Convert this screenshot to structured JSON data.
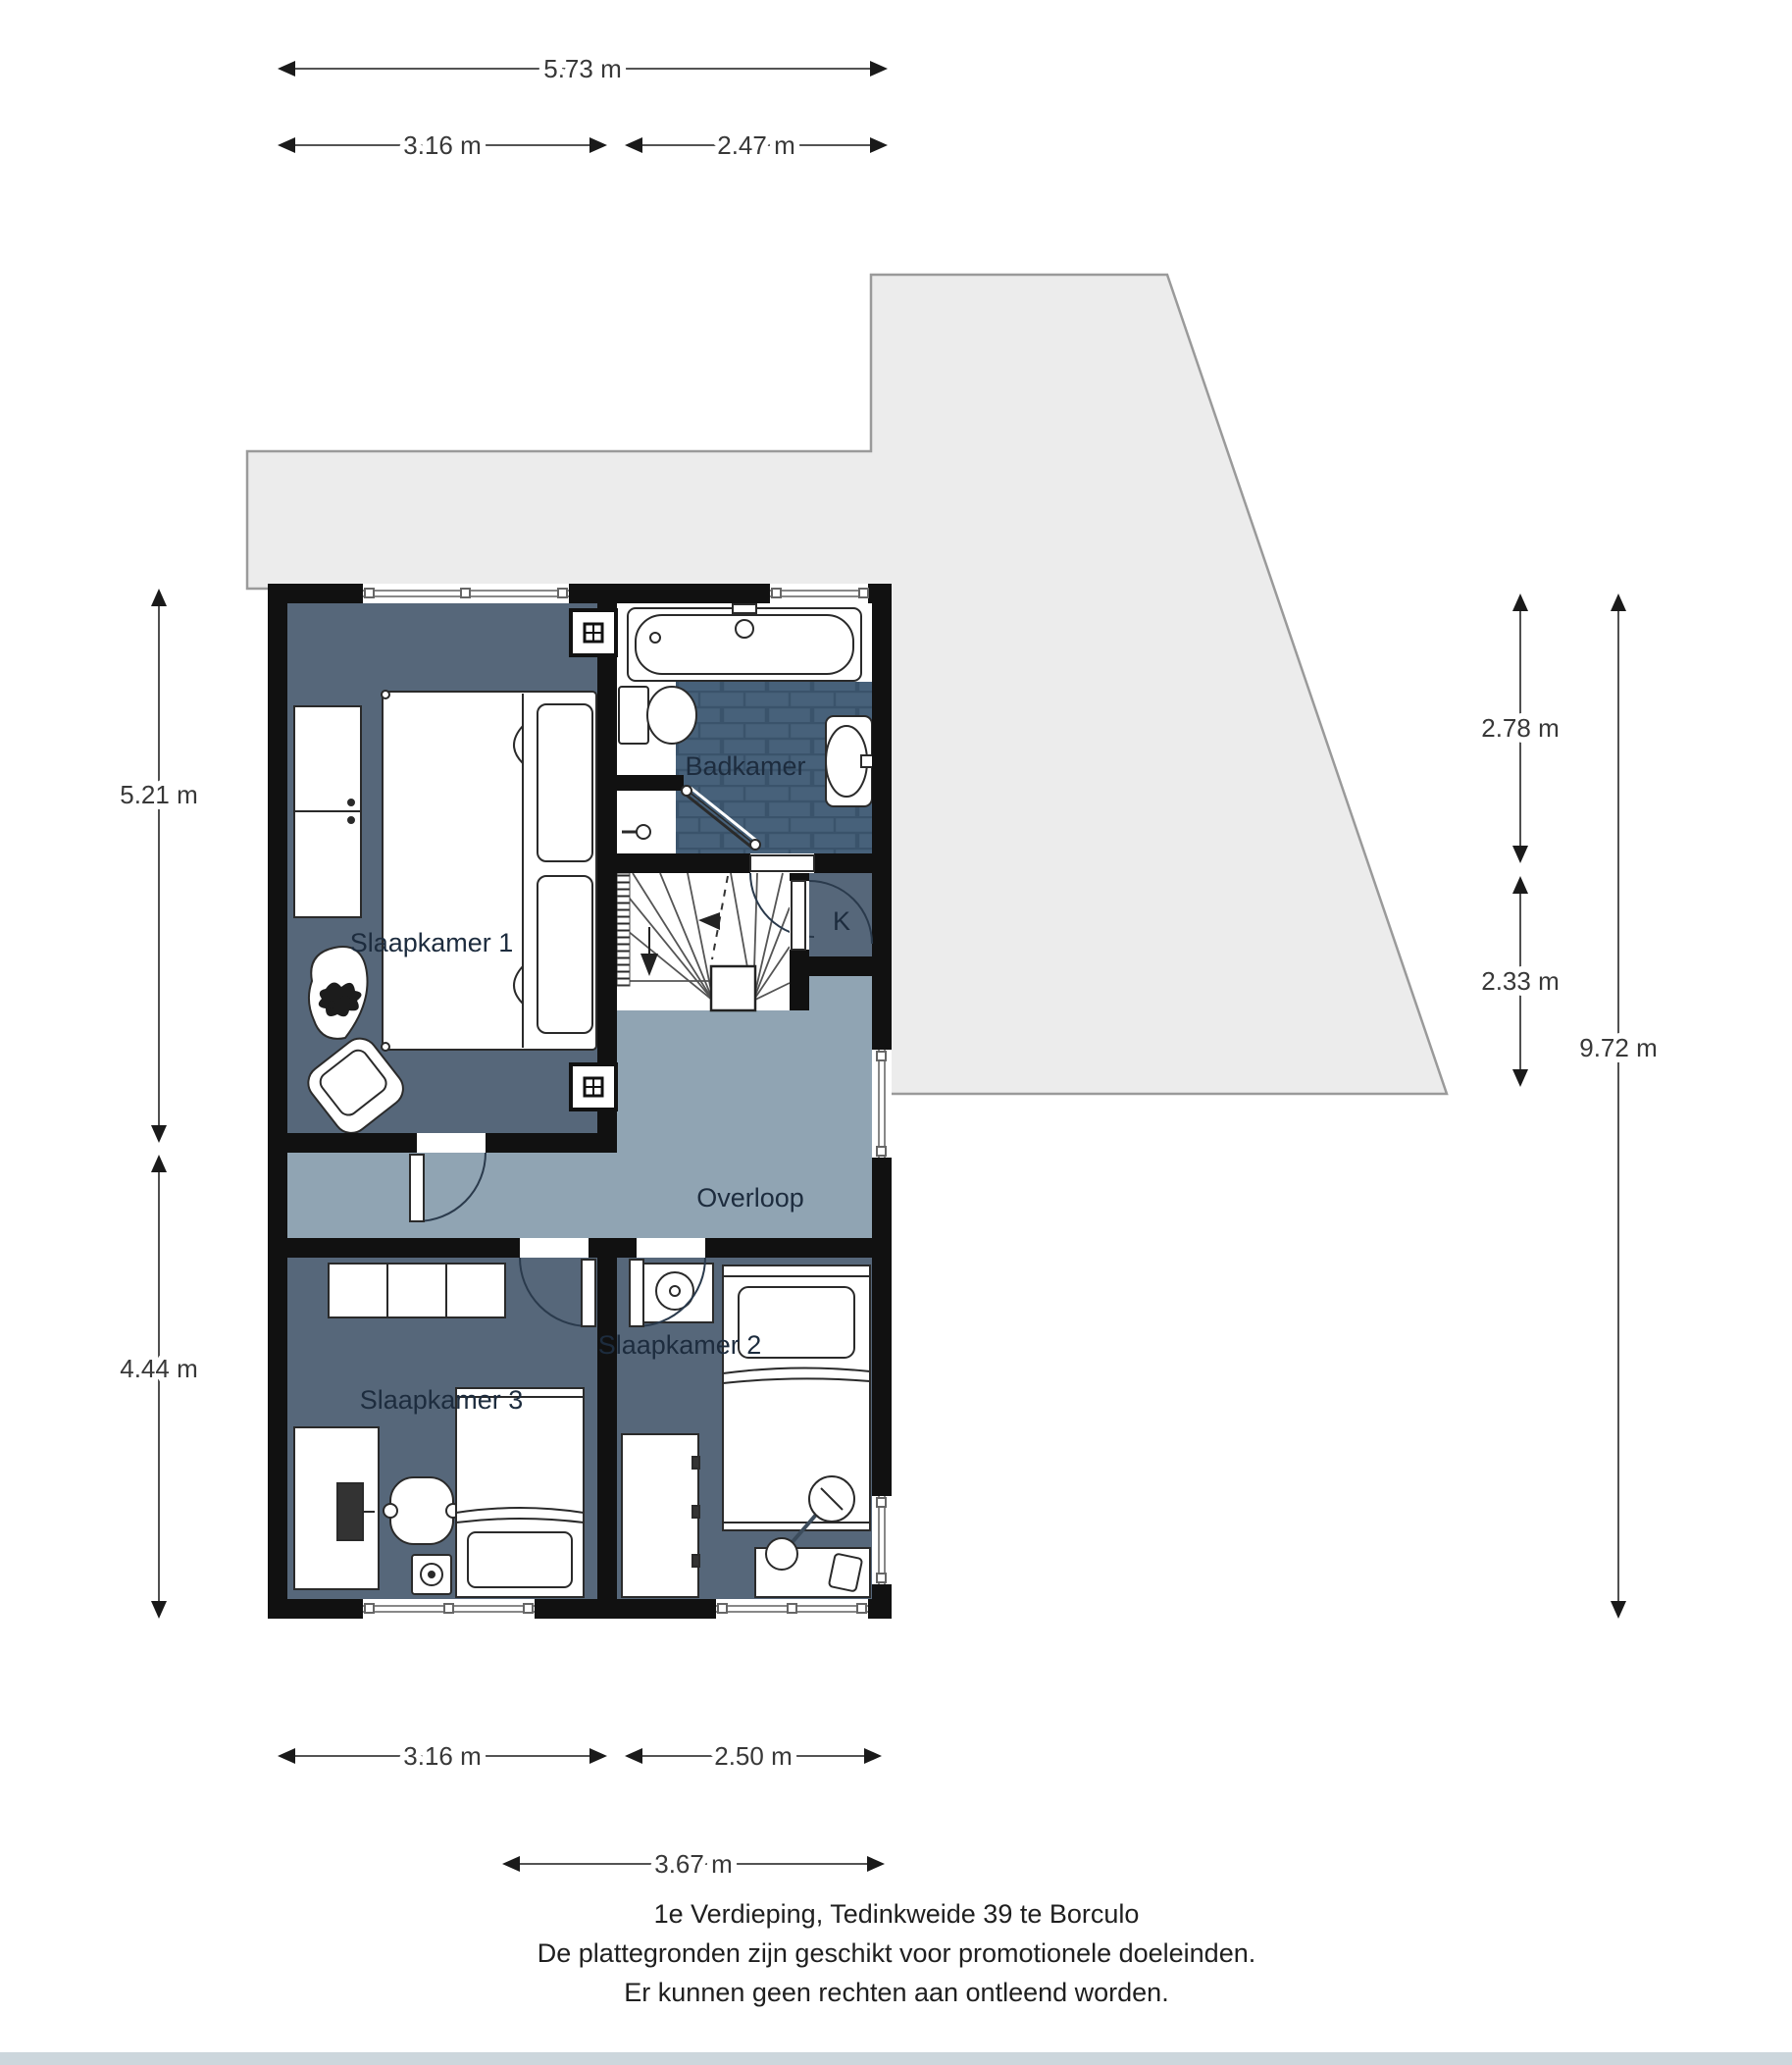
{
  "floorplan": {
    "rooms": {
      "slaapkamer1": "Slaapkamer 1",
      "badkamer": "Badkamer",
      "kast": "K",
      "overloop": "Overloop",
      "slaapkamer3": "Slaapkamer 3",
      "slaapkamer2": "Slaapkamer 2"
    },
    "dimensions": {
      "top_total": "5.73 m",
      "top_left": "3.16 m",
      "top_right": "2.47 m",
      "left_upper": "5.21 m",
      "left_lower": "4.44 m",
      "right_upper": "2.78 m",
      "right_middle": "2.33 m",
      "right_total": "9.72 m",
      "bottom_left": "3.16 m",
      "bottom_right": "2.50 m",
      "bottom_total": "3.67 m"
    },
    "caption": {
      "line1": "1e Verdieping, Tedinkweide 39 te Borculo",
      "line2": "De plattegronden zijn geschikt voor promotionele doeleinden.",
      "line3": "Er kunnen geen rechten aan ontleend worden."
    },
    "colors": {
      "room_fill": "#56677a",
      "hall_fill": "#90a4b3",
      "tile_fill": "#47617a",
      "tile_line": "#3a536b",
      "wall": "#111111",
      "roof_fill": "#ececec",
      "roof_stroke": "#9a9a9a"
    }
  }
}
